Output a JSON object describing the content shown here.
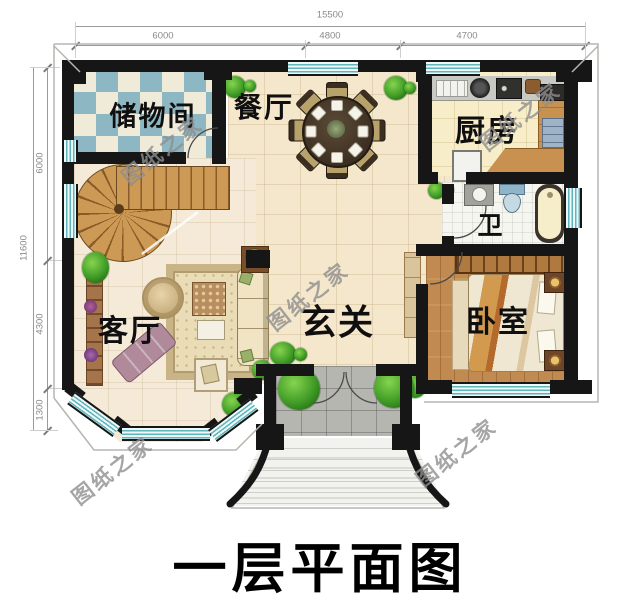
{
  "title": "一层平面图",
  "watermark": {
    "text": "图纸之家"
  },
  "dimensions": {
    "top": {
      "total": "15500",
      "segments": [
        "6000",
        "4800",
        "4700"
      ]
    },
    "left": {
      "total": "11600",
      "segments": [
        "6000",
        "4300",
        "1300"
      ]
    }
  },
  "rooms": {
    "storage": "储物间",
    "dining": "餐厅",
    "kitchen": "厨房",
    "bath": "卫",
    "foyer": "玄关",
    "living": "客厅",
    "bedroom": "卧室"
  },
  "colors": {
    "wall": "#161616",
    "window_teal": "#5fb5ba",
    "checker_teal": "#8cb7c3",
    "wood_tile_floor": "#f4e7cb",
    "counter_wood": "#c8914f",
    "bedroom_floor": "#c18a50",
    "porch_gray": "#b6b6b0",
    "plant_green": "#3f9b26",
    "watermark_gray": "#8f8f8f",
    "dimension_gray": "#8a8a8a",
    "title_black": "#000000"
  }
}
